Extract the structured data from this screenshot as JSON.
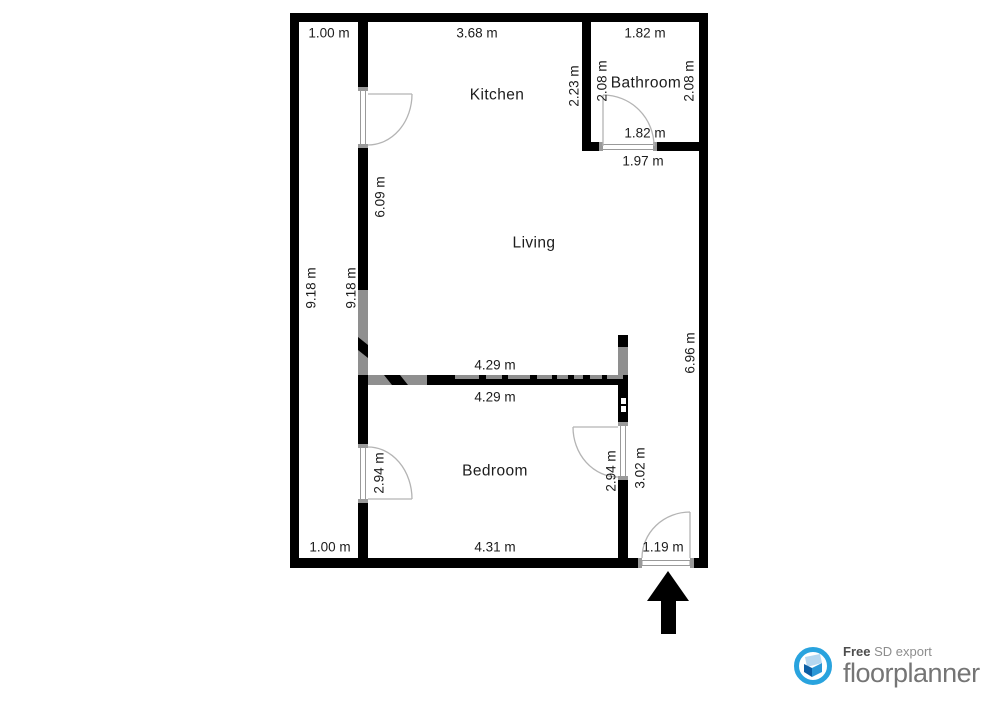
{
  "rooms": {
    "kitchen": "Kitchen",
    "living": "Living",
    "bathroom": "Bathroom",
    "bedroom": "Bedroom"
  },
  "dims": {
    "corridor_top": "1.00 m",
    "kitchen_width": "3.68 m",
    "bathroom_width_top": "1.82 m",
    "bathroom_height_left": "2.08 m",
    "bathroom_height_right": "2.08 m",
    "bathroom_door_width": "1.82 m",
    "bathroom_bottom_width": "1.97 m",
    "kitchen_bath_wall": "2.23 m",
    "kitchen_wall_height": "6.09 m",
    "left_wall_height_outer": "9.18 m",
    "left_wall_height_inner": "9.18 m",
    "right_corridor_height": "6.96 m",
    "living_width": "4.29 m",
    "bedroom_top_width": "4.29 m",
    "bedroom_door_left": "2.94 m",
    "bedroom_door_right": "2.94 m",
    "bedroom_right_wall": "3.02 m",
    "corridor_bottom": "1.00 m",
    "bedroom_width": "4.31 m",
    "entrance_door_width": "1.19 m"
  },
  "branding": {
    "free_label": "Free",
    "export_label": "SD export",
    "brand_name": "floorplanner"
  },
  "colors": {
    "bg": "#ffffff",
    "wall": "#000000",
    "ink": "#1c1c1c",
    "door": "#b4b4b4",
    "jamb": "#9a9a9a",
    "watermark": "#8f8f8f",
    "brand_blue": "#29a3de",
    "brand_dark": "#4d4d4d",
    "brand_gray": "#8d8d8d",
    "brand_name_gray": "#757575"
  }
}
